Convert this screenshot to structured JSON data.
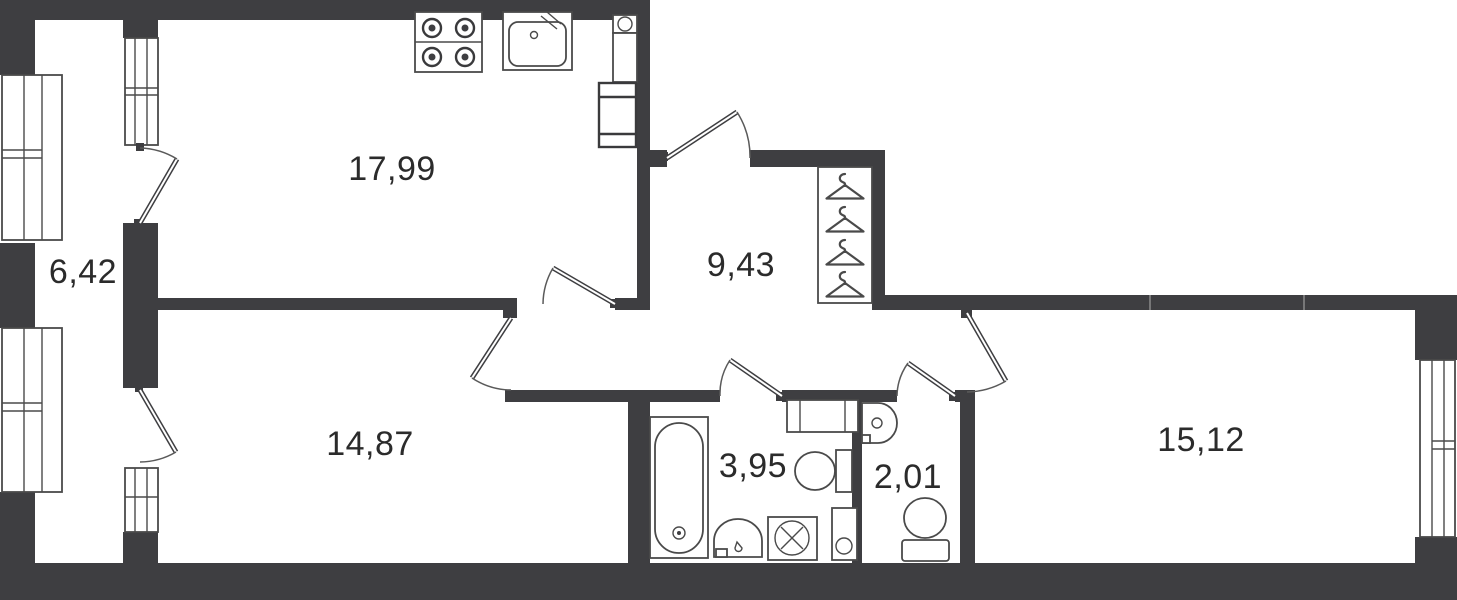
{
  "plan": {
    "title": "apartment-floor-plan",
    "rooms": {
      "kitchen_living": {
        "name": "kitchen-living-room",
        "area": "17,99"
      },
      "balcony": {
        "name": "balcony",
        "area": "6,42"
      },
      "hallway": {
        "name": "hallway",
        "area": "9,43"
      },
      "room_left": {
        "name": "bedroom-left",
        "area": "14,87"
      },
      "bathroom": {
        "name": "bathroom",
        "area": "3,95"
      },
      "wc": {
        "name": "wc",
        "area": "2,01"
      },
      "room_right": {
        "name": "bedroom-right",
        "area": "15,12"
      }
    },
    "fixtures": {
      "kitchen_living": [
        "stove-4-burners",
        "kitchen-sink",
        "ventilation-box",
        "cabinet",
        "refrigerator"
      ],
      "hallway": [
        "wardrobe-with-4-hangers"
      ],
      "bathroom": [
        "bathtub",
        "washbasin",
        "toilet",
        "washing-machine",
        "water-heater",
        "vent-shaft"
      ],
      "wc": [
        "washbasin",
        "toilet"
      ]
    },
    "openings": {
      "windows": [
        "balcony-window-upper",
        "balcony-window-lower",
        "balcony-inner-window-upper",
        "balcony-inner-window-lower",
        "room-right-window"
      ],
      "doors": [
        "balcony-door-kitchen",
        "balcony-door-room-left",
        "entrance-door",
        "kitchen-door",
        "room-left-door",
        "bathroom-door",
        "wc-door",
        "room-right-door"
      ]
    },
    "colors": {
      "wall": "#3e3e41",
      "line": "#4a4a4a",
      "text": "#2b2b2b",
      "bg": "#ffffff"
    }
  }
}
